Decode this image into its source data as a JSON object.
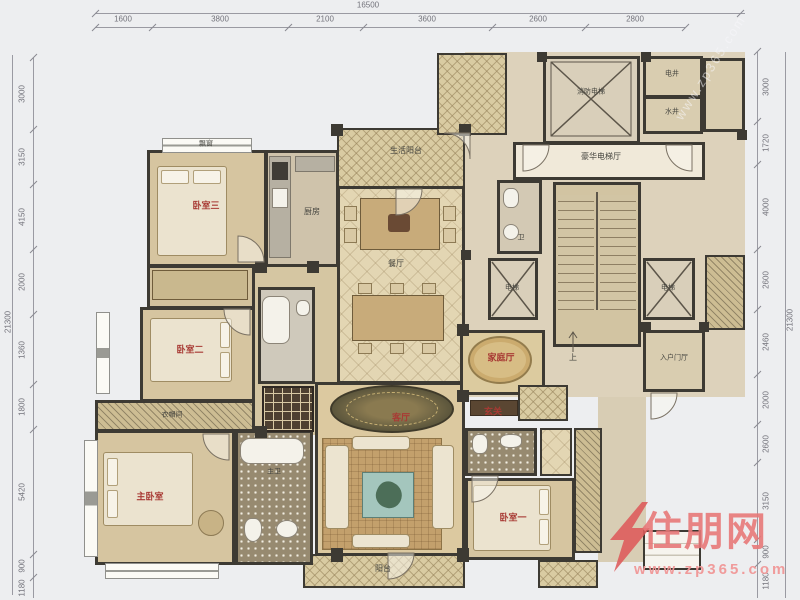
{
  "rulers": {
    "top": {
      "total": "16500",
      "segments": [
        "1600",
        "3800",
        "2100",
        "3600",
        "2600",
        "2800"
      ]
    },
    "left": {
      "total": "21300",
      "segments": [
        "3000",
        "3150",
        "4150",
        "2000",
        "1360",
        "1800",
        "5420",
        "900",
        "1180"
      ]
    },
    "right": {
      "total": "21300",
      "segments": [
        "3000",
        "1720",
        "4000",
        "2600",
        "2460",
        "2000",
        "2600",
        "3150",
        "900",
        "1180"
      ]
    }
  },
  "rooms": {
    "bedroom3": "卧室三",
    "bedroom2": "卧室二",
    "master_bedroom": "主卧室",
    "bedroom1": "卧室一",
    "living_room": "客厅",
    "dining_room": "餐厅",
    "kitchen": "厨房",
    "family_hall": "家庭厅",
    "life_balcony": "生活阳台",
    "balcony": "阳台",
    "cloakroom": "衣帽间",
    "master_bath": "主卫",
    "bath": "卫",
    "fire_elevator": "消防电梯",
    "elevator_hall": "豪华电梯厅",
    "elevator": "电梯",
    "stairs_up": "上",
    "entry_hall": "入户门厅",
    "foyer": "玄关",
    "shaft_electric": "电井",
    "shaft_water": "水井",
    "bay_window": "飘窗"
  },
  "watermark": {
    "brand": "住朋网",
    "site": "www.zp365.com",
    "diagonal": "www.zp365.com"
  },
  "colors": {
    "wall": "#3d3a33",
    "floor_tan": "#d6c5a0",
    "label_red": "#a83a34",
    "watermark_pink": "#e97878"
  }
}
